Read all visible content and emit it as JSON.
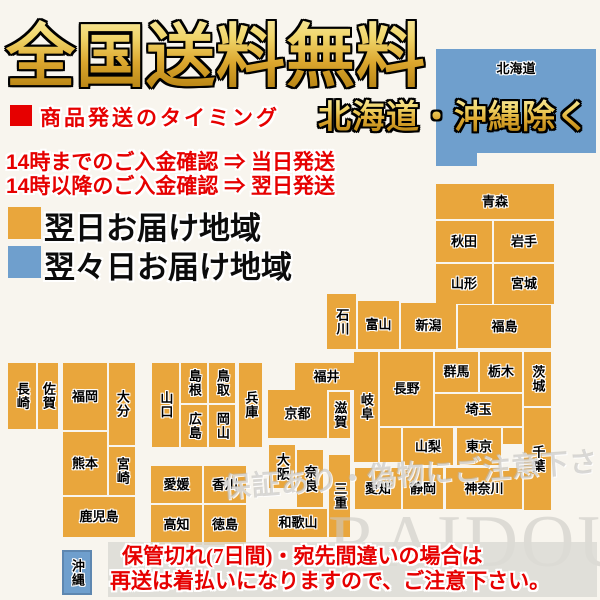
{
  "header": {
    "title": "全国送料無料",
    "subtitle": "北海道・沖縄除く"
  },
  "shipping_timing": {
    "bullet_heading": "商品発送のタイミング",
    "rules": [
      "14時までのご入金確認 ⇒ 当日発送",
      "14時以降のご入金確認 ⇒ 翌日発送"
    ]
  },
  "legend": {
    "items": [
      {
        "label": "翌日お届け地域",
        "color": "#E9A63C",
        "zone": "next_day"
      },
      {
        "label": "翌々日お届け地域",
        "color": "#6F9FCD",
        "zone": "two_day"
      }
    ]
  },
  "notice": {
    "lines": [
      "保管切れ(7日間)・宛先間違いの場合は",
      "再送は着払いになりますので、ご注意下さい。"
    ]
  },
  "watermarks": {
    "caution": "保証あり・偽物にご注意下さい",
    "brand": "RAIDOU"
  },
  "colors": {
    "background": "#F8F5EE",
    "next_day": "#E9A63C",
    "two_day": "#6F9FCD",
    "accent_red": "#E60000",
    "gold_light": "#FDF6C8",
    "gold_dark": "#A97608",
    "notice_bar": "#DCDAD5"
  },
  "map": {
    "regions": [
      {
        "id": "hokkaido",
        "label": "北海道",
        "x": 436,
        "y": 49,
        "w": 160,
        "h": 104,
        "orient": "h",
        "zone": "two_day",
        "labelPos": "top"
      },
      {
        "id": "hokkaido-tail",
        "label": "",
        "x": 436,
        "y": 153,
        "w": 41,
        "h": 13,
        "orient": "h",
        "zone": "two_day"
      },
      {
        "id": "aomori",
        "label": "青森",
        "x": 436,
        "y": 184,
        "w": 118,
        "h": 35,
        "orient": "h",
        "zone": "next_day"
      },
      {
        "id": "akita",
        "label": "秋田",
        "x": 436,
        "y": 221,
        "w": 56,
        "h": 41,
        "orient": "h",
        "zone": "next_day"
      },
      {
        "id": "iwate",
        "label": "岩手",
        "x": 494,
        "y": 221,
        "w": 60,
        "h": 41,
        "orient": "h",
        "zone": "next_day"
      },
      {
        "id": "yamagata",
        "label": "山形",
        "x": 436,
        "y": 264,
        "w": 56,
        "h": 40,
        "orient": "h",
        "zone": "next_day"
      },
      {
        "id": "miyagi",
        "label": "宮城",
        "x": 494,
        "y": 264,
        "w": 60,
        "h": 40,
        "orient": "h",
        "zone": "next_day"
      },
      {
        "id": "ishikawa",
        "label": "石川",
        "x": 327,
        "y": 294,
        "w": 29,
        "h": 55,
        "orient": "v",
        "zone": "next_day"
      },
      {
        "id": "toyama",
        "label": "富山",
        "x": 358,
        "y": 301,
        "w": 41,
        "h": 48,
        "orient": "h",
        "zone": "next_day"
      },
      {
        "id": "niigata",
        "label": "新潟",
        "x": 401,
        "y": 303,
        "w": 55,
        "h": 46,
        "orient": "h",
        "zone": "next_day"
      },
      {
        "id": "fukushima",
        "label": "福島",
        "x": 458,
        "y": 305,
        "w": 93,
        "h": 43,
        "orient": "h",
        "zone": "next_day"
      },
      {
        "id": "gunma",
        "label": "群馬",
        "x": 435,
        "y": 352,
        "w": 43,
        "h": 40,
        "orient": "h",
        "zone": "next_day"
      },
      {
        "id": "tochigi",
        "label": "栃木",
        "x": 480,
        "y": 352,
        "w": 42,
        "h": 40,
        "orient": "h",
        "zone": "next_day"
      },
      {
        "id": "ibaraki",
        "label": "茨城",
        "x": 524,
        "y": 352,
        "w": 27,
        "h": 54,
        "orient": "v",
        "zone": "next_day"
      },
      {
        "id": "saitama",
        "label": "埼玉",
        "x": 435,
        "y": 394,
        "w": 87,
        "h": 32,
        "orient": "h",
        "zone": "next_day"
      },
      {
        "id": "chiba",
        "label": "千葉",
        "x": 524,
        "y": 408,
        "w": 27,
        "h": 102,
        "orient": "v",
        "zone": "next_day"
      },
      {
        "id": "yamanashi",
        "label": "山梨",
        "x": 403,
        "y": 428,
        "w": 50,
        "h": 37,
        "orient": "h",
        "zone": "next_day"
      },
      {
        "id": "tokyo",
        "label": "東京",
        "x": 457,
        "y": 428,
        "w": 44,
        "h": 37,
        "orient": "h",
        "zone": "next_day"
      },
      {
        "id": "tokyo-bay-north",
        "label": "",
        "x": 503,
        "y": 428,
        "w": 19,
        "h": 16,
        "orient": "h",
        "zone": "next_day"
      },
      {
        "id": "kanagawa",
        "label": "神奈川",
        "x": 446,
        "y": 468,
        "w": 76,
        "h": 41,
        "orient": "h",
        "zone": "next_day"
      },
      {
        "id": "nagano",
        "label": "長野",
        "x": 380,
        "y": 352,
        "w": 53,
        "h": 74,
        "orient": "h",
        "zone": "next_day"
      },
      {
        "id": "gifu",
        "label": "岐阜",
        "x": 354,
        "y": 352,
        "w": 24,
        "h": 110,
        "orient": "v",
        "zone": "next_day"
      },
      {
        "id": "nagano-south",
        "label": "",
        "x": 380,
        "y": 428,
        "w": 21,
        "h": 34,
        "orient": "h",
        "zone": "next_day"
      },
      {
        "id": "aichi",
        "label": "愛知",
        "x": 355,
        "y": 468,
        "w": 46,
        "h": 41,
        "orient": "h",
        "zone": "next_day"
      },
      {
        "id": "shizuoka",
        "label": "静岡",
        "x": 403,
        "y": 468,
        "w": 40,
        "h": 41,
        "orient": "h",
        "zone": "next_day"
      },
      {
        "id": "fukui",
        "label": "福井",
        "x": 295,
        "y": 363,
        "w": 63,
        "h": 27,
        "orient": "h",
        "zone": "next_day"
      },
      {
        "id": "shiga",
        "label": "滋賀",
        "x": 329,
        "y": 392,
        "w": 21,
        "h": 46,
        "orient": "v",
        "zone": "next_day"
      },
      {
        "id": "kyoto",
        "label": "京都",
        "x": 268,
        "y": 390,
        "w": 59,
        "h": 48,
        "orient": "h",
        "zone": "next_day"
      },
      {
        "id": "hyogo",
        "label": "兵庫",
        "x": 239,
        "y": 363,
        "w": 23,
        "h": 84,
        "orient": "v",
        "zone": "next_day"
      },
      {
        "id": "osaka",
        "label": "大阪",
        "x": 269,
        "y": 445,
        "w": 26,
        "h": 43,
        "orient": "v",
        "zone": "next_day"
      },
      {
        "id": "nara",
        "label": "奈良",
        "x": 297,
        "y": 450,
        "w": 26,
        "h": 57,
        "orient": "v",
        "zone": "next_day"
      },
      {
        "id": "wakayama",
        "label": "和歌山",
        "x": 269,
        "y": 509,
        "w": 58,
        "h": 28,
        "orient": "h",
        "zone": "next_day"
      },
      {
        "id": "mie",
        "label": "三重",
        "x": 329,
        "y": 455,
        "w": 21,
        "h": 82,
        "orient": "v",
        "zone": "next_day"
      },
      {
        "id": "tottori",
        "label": "鳥取",
        "x": 209,
        "y": 363,
        "w": 26,
        "h": 40,
        "orient": "v",
        "zone": "next_day"
      },
      {
        "id": "okayama",
        "label": "岡山",
        "x": 209,
        "y": 405,
        "w": 26,
        "h": 42,
        "orient": "v",
        "zone": "next_day"
      },
      {
        "id": "shimane",
        "label": "島根",
        "x": 181,
        "y": 363,
        "w": 26,
        "h": 40,
        "orient": "v",
        "zone": "next_day"
      },
      {
        "id": "hiroshima",
        "label": "広島",
        "x": 181,
        "y": 405,
        "w": 26,
        "h": 42,
        "orient": "v",
        "zone": "next_day"
      },
      {
        "id": "yamaguchi",
        "label": "山口",
        "x": 152,
        "y": 363,
        "w": 27,
        "h": 84,
        "orient": "v",
        "zone": "next_day"
      },
      {
        "id": "ehime",
        "label": "愛媛",
        "x": 151,
        "y": 466,
        "w": 51,
        "h": 37,
        "orient": "h",
        "zone": "next_day"
      },
      {
        "id": "kagawa",
        "label": "香川",
        "x": 204,
        "y": 466,
        "w": 42,
        "h": 37,
        "orient": "h",
        "zone": "next_day"
      },
      {
        "id": "kochi",
        "label": "高知",
        "x": 151,
        "y": 505,
        "w": 51,
        "h": 40,
        "orient": "h",
        "zone": "next_day"
      },
      {
        "id": "tokushima",
        "label": "徳島",
        "x": 204,
        "y": 505,
        "w": 42,
        "h": 40,
        "orient": "h",
        "zone": "next_day"
      },
      {
        "id": "fukuoka",
        "label": "福岡",
        "x": 63,
        "y": 363,
        "w": 44,
        "h": 67,
        "orient": "h",
        "zone": "next_day"
      },
      {
        "id": "oita",
        "label": "大分",
        "x": 109,
        "y": 363,
        "w": 26,
        "h": 82,
        "orient": "v",
        "zone": "next_day"
      },
      {
        "id": "kumamoto",
        "label": "熊本",
        "x": 63,
        "y": 432,
        "w": 44,
        "h": 63,
        "orient": "h",
        "zone": "next_day"
      },
      {
        "id": "miyazaki",
        "label": "宮崎",
        "x": 109,
        "y": 447,
        "w": 26,
        "h": 48,
        "orient": "v",
        "zone": "next_day"
      },
      {
        "id": "kagoshima",
        "label": "鹿児島",
        "x": 63,
        "y": 497,
        "w": 72,
        "h": 40,
        "orient": "h",
        "zone": "next_day"
      },
      {
        "id": "nagasaki",
        "label": "長崎",
        "x": 8,
        "y": 363,
        "w": 28,
        "h": 66,
        "orient": "v",
        "zone": "next_day"
      },
      {
        "id": "saga",
        "label": "佐賀",
        "x": 38,
        "y": 363,
        "w": 20,
        "h": 66,
        "orient": "v",
        "zone": "next_day"
      },
      {
        "id": "okinawa",
        "label": "沖縄",
        "x": 62,
        "y": 550,
        "w": 30,
        "h": 45,
        "orient": "v",
        "zone": "two_day",
        "border": true
      }
    ]
  }
}
